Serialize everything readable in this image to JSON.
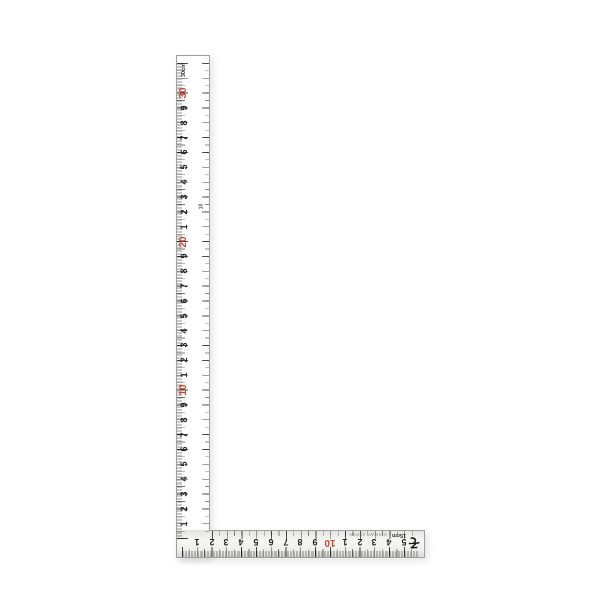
{
  "product": {
    "kind": "L-shaped carpenter square ruler (sashigane)",
    "background": "#ffffff"
  },
  "colors": {
    "red_numeral": "#c34a35",
    "black_numeral": "#26262b",
    "metal_light": "#f7f7f4",
    "metal_dark": "#d6d6d2"
  },
  "scale": {
    "unit": "cm",
    "vertical_length_label": "30cm",
    "horizontal_length_label": "15cm",
    "vertical_inner_mark": "10"
  },
  "vertical_arm": {
    "unit_label": "30cm",
    "numbers": [
      {
        "value": 1,
        "label": "1",
        "red": false
      },
      {
        "value": 2,
        "label": "2",
        "red": false
      },
      {
        "value": 3,
        "label": "3",
        "red": false
      },
      {
        "value": 4,
        "label": "4",
        "red": false
      },
      {
        "value": 5,
        "label": "5",
        "red": false
      },
      {
        "value": 6,
        "label": "6",
        "red": false
      },
      {
        "value": 7,
        "label": "7",
        "red": false
      },
      {
        "value": 8,
        "label": "8",
        "red": false
      },
      {
        "value": 9,
        "label": "9",
        "red": false
      },
      {
        "value": 10,
        "label": "10",
        "red": true
      },
      {
        "value": 11,
        "label": "1",
        "red": false
      },
      {
        "value": 12,
        "label": "2",
        "red": false
      },
      {
        "value": 13,
        "label": "3",
        "red": false
      },
      {
        "value": 14,
        "label": "4",
        "red": false
      },
      {
        "value": 15,
        "label": "5",
        "red": false
      },
      {
        "value": 16,
        "label": "6",
        "red": false
      },
      {
        "value": 17,
        "label": "7",
        "red": false
      },
      {
        "value": 18,
        "label": "8",
        "red": false
      },
      {
        "value": 19,
        "label": "9",
        "red": false
      },
      {
        "value": 20,
        "label": "20",
        "red": true
      },
      {
        "value": 21,
        "label": "1",
        "red": false
      },
      {
        "value": 22,
        "label": "2",
        "red": false
      },
      {
        "value": 23,
        "label": "3",
        "red": false
      },
      {
        "value": 24,
        "label": "4",
        "red": false
      },
      {
        "value": 25,
        "label": "5",
        "red": false
      },
      {
        "value": 26,
        "label": "6",
        "red": false
      },
      {
        "value": 27,
        "label": "7",
        "red": false
      },
      {
        "value": 28,
        "label": "8",
        "red": false
      },
      {
        "value": 29,
        "label": "9",
        "red": false
      },
      {
        "value": 30,
        "label": "30",
        "red": true
      }
    ]
  },
  "horizontal_arm": {
    "unit_label": "15cm",
    "small_print": "SHINWA JAPAN",
    "brand_mark": "そ",
    "numbers": [
      {
        "value": 1,
        "label": "1",
        "red": false
      },
      {
        "value": 2,
        "label": "2",
        "red": false
      },
      {
        "value": 3,
        "label": "3",
        "red": false
      },
      {
        "value": 4,
        "label": "4",
        "red": false
      },
      {
        "value": 5,
        "label": "5",
        "red": false
      },
      {
        "value": 6,
        "label": "6",
        "red": false
      },
      {
        "value": 7,
        "label": "7",
        "red": false
      },
      {
        "value": 8,
        "label": "8",
        "red": false
      },
      {
        "value": 9,
        "label": "9",
        "red": false
      },
      {
        "value": 10,
        "label": "10",
        "red": true
      },
      {
        "value": 11,
        "label": "1",
        "red": false
      },
      {
        "value": 12,
        "label": "2",
        "red": false
      },
      {
        "value": 13,
        "label": "3",
        "red": false
      },
      {
        "value": 14,
        "label": "4",
        "red": false
      },
      {
        "value": 15,
        "label": "5",
        "red": false
      }
    ]
  }
}
